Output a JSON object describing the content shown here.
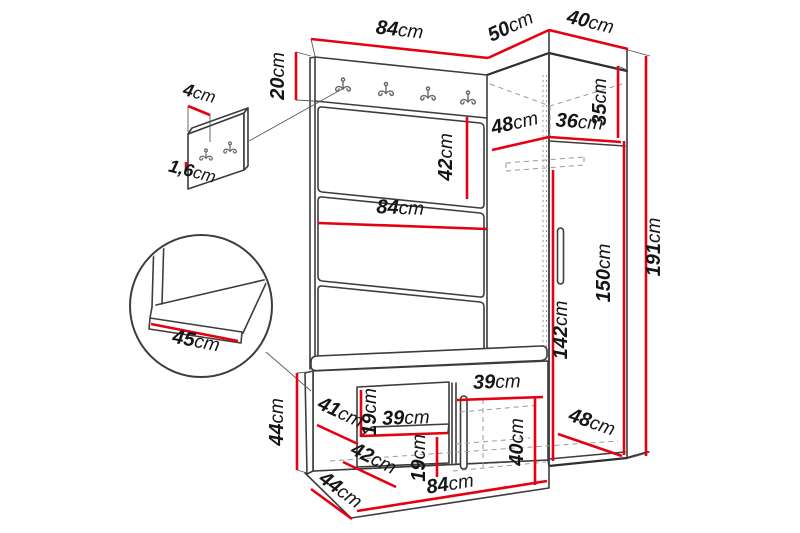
{
  "diagram": {
    "title": "hallway-furniture-dimension-diagram",
    "subject": "wardrobe set with coat hook panel, tall cabinet and shoe bench",
    "unit": "cm",
    "colors": {
      "dimension_line": "#e60012",
      "outline": "#3d3d3d",
      "hidden_line": "#9a9a9a",
      "label_text": "#151515",
      "background": "#ffffff"
    }
  },
  "dims": {
    "top_width": {
      "value": "84",
      "unit": "cm"
    },
    "top_depth": {
      "value": "50",
      "unit": "cm"
    },
    "wardrobe_top_width": {
      "value": "40",
      "unit": "cm"
    },
    "hook_rail_height": {
      "value": "20",
      "unit": "cm"
    },
    "hook_panel_depth": {
      "value": "4",
      "unit": "cm"
    },
    "hook_panel_thickness": {
      "value": "1,6",
      "unit": "cm"
    },
    "panel_section_height": {
      "value": "42",
      "unit": "cm"
    },
    "panel_width": {
      "value": "84",
      "unit": "cm"
    },
    "seat_detail_depth": {
      "value": "45",
      "unit": "cm"
    },
    "wardrobe_top_depth_inner": {
      "value": "48",
      "unit": "cm"
    },
    "wardrobe_top_width_inner": {
      "value": "36",
      "unit": "cm"
    },
    "wardrobe_top_height": {
      "value": "35",
      "unit": "cm"
    },
    "wardrobe_height": {
      "value": "191",
      "unit": "cm"
    },
    "wardrobe_door_height": {
      "value": "150",
      "unit": "cm"
    },
    "wardrobe_interior_height": {
      "value": "142",
      "unit": "cm"
    },
    "wardrobe_bottom_depth": {
      "value": "48",
      "unit": "cm"
    },
    "bench_height": {
      "value": "44",
      "unit": "cm"
    },
    "bench_shelf_depth_upper": {
      "value": "41",
      "unit": "cm"
    },
    "bench_gap_upper": {
      "value": "19",
      "unit": "cm"
    },
    "bench_shelf_width_left": {
      "value": "39",
      "unit": "cm"
    },
    "bench_shelf_depth_lower": {
      "value": "42",
      "unit": "cm"
    },
    "bench_gap_lower": {
      "value": "19",
      "unit": "cm"
    },
    "bench_shelf_width_right": {
      "value": "39",
      "unit": "cm"
    },
    "bench_compartment_height": {
      "value": "40",
      "unit": "cm"
    },
    "bench_depth": {
      "value": "44",
      "unit": "cm"
    },
    "bench_width": {
      "value": "84",
      "unit": "cm"
    }
  }
}
